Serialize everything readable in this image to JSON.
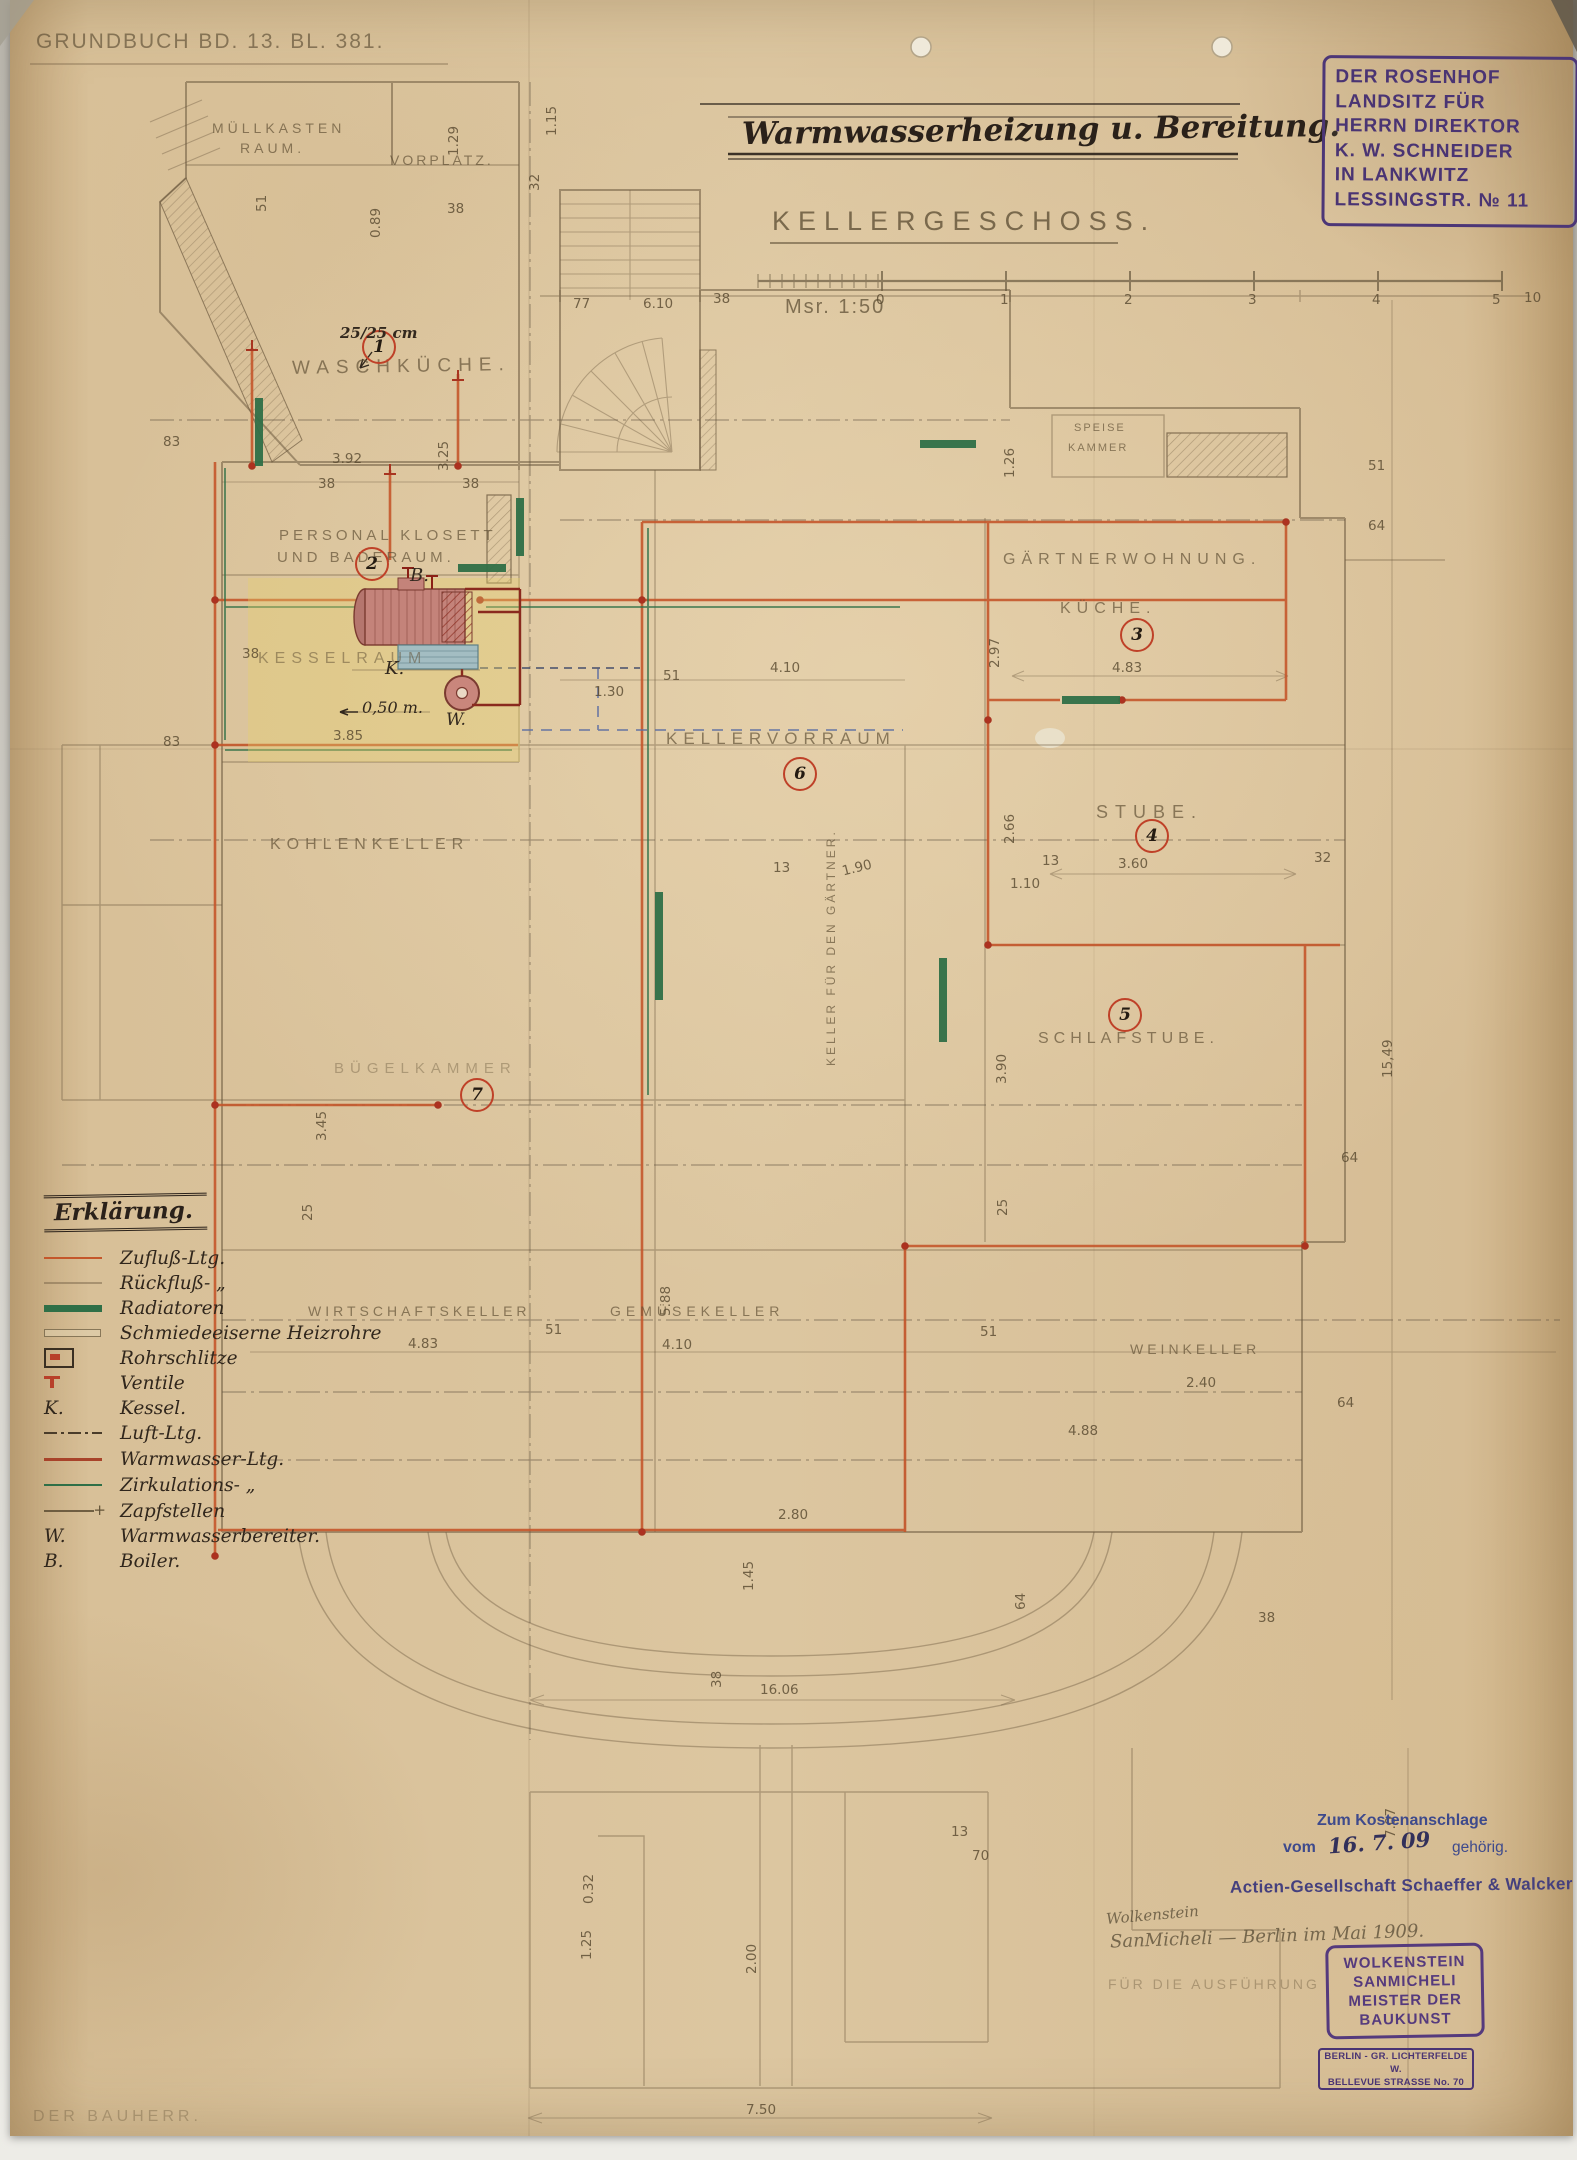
{
  "header": {
    "grundbuch": "Grundbuch Bd. 13. Bl. 381.",
    "title": "Warmwasserheizung u. Bereitung.",
    "floor": "Kellergeschoss.",
    "scale": "Msr. 1:50",
    "scale_ticks": [
      "0",
      "1",
      "2",
      "3",
      "4",
      "5"
    ]
  },
  "owner_stamp": {
    "l1": "DER ROSENHOF",
    "l2": "LANDSITZ FÜR",
    "l3": "HERRN DIREKTOR",
    "l4": "K. W. SCHNEIDER",
    "l5": "IN LANKWITZ",
    "l6": "LESSINGSTR. № 11"
  },
  "rooms": {
    "muellkasten_1": "Müllkasten",
    "muellkasten_2": "Raum.",
    "vorplatz": "Vorplatz.",
    "waschkueche": {
      "number": "1",
      "label": "Waschküche."
    },
    "bad": {
      "number": "2",
      "line1": "Personal Klosett",
      "line2": "und Baderaum."
    },
    "kesselraum": "Kesselraum",
    "gaertner": {
      "number": "3",
      "line1": "Gärtnerwohnung.",
      "line2": "Küche."
    },
    "speisekammer_1": "Speise",
    "speisekammer_2": "Kammer",
    "kellervorraum": {
      "number": "6",
      "label": "Kellervorraum"
    },
    "stube": {
      "number": "4",
      "label": "Stube."
    },
    "schlafstube": {
      "number": "5",
      "label": "Schlafstube."
    },
    "kohlenkeller": "Kohlenkeller",
    "buegelkammer": {
      "number": "7",
      "label": "Bügelkammer"
    },
    "wirtschaftskeller": "Wirtschaftskeller",
    "gemuesekeller": "Gemüsekeller",
    "weinkeller": "Weinkeller",
    "gaertnerkeller": "Keller für den Gärtner."
  },
  "annotations": {
    "boiler": "B.",
    "kessel": "K.",
    "warmwasser": "W.",
    "pipe_size": "25/25 cm",
    "depth": "0,50 m."
  },
  "legend": {
    "heading": "Erklärung.",
    "items": [
      {
        "prefix": "",
        "label": "Zufluß-Ltg."
      },
      {
        "prefix": "",
        "label": "Rückfluß- „"
      },
      {
        "prefix": "",
        "label": "Radiatoren"
      },
      {
        "prefix": "",
        "label": "Schmiedeeiserne Heizrohre"
      },
      {
        "prefix": "",
        "label": "Rohrschlitze"
      },
      {
        "prefix": "",
        "label": "Ventile"
      },
      {
        "prefix": "K.",
        "label": "Kessel."
      },
      {
        "prefix": "",
        "label": "Luft-Ltg."
      },
      {
        "prefix": "",
        "label": "Warmwasser-Ltg."
      },
      {
        "prefix": "",
        "label": "Zirkulations- „"
      },
      {
        "prefix": "",
        "label": "Zapfstellen"
      },
      {
        "prefix": "W.",
        "label": "Warmwasserbereiter."
      },
      {
        "prefix": "B.",
        "label": "Boiler."
      }
    ]
  },
  "footer": {
    "bauherr": "Der Bauherr.",
    "kosten_1": "Zum Kostenanschlage",
    "kosten_vom": "vom",
    "kosten_date": "16. 7. 09",
    "kosten_2": "gehörig.",
    "firm": "Actien-Gesellschaft Schaeffer & Walcker",
    "sig_1": "Wolkenstein",
    "sig_2": "SanMicheli — Berlin im Mai 1909.",
    "ausfuehrung": "Für die Ausführung",
    "builder_stamp": {
      "l1": "WOLKENSTEIN",
      "l2": "SANMICHELI",
      "l3": "MEISTER DER",
      "l4": "BAUKUNST"
    },
    "address_stamp": {
      "l1": "BERLIN - GR. LICHTERFELDE W.",
      "l2": "BELLEVUE STRASSE No. 70"
    }
  },
  "dims": {
    "d01": "3.92",
    "d02": "38",
    "d03": "38",
    "d04": "3.25",
    "d05": "83",
    "d06": "83",
    "d07": "77",
    "d08": "38",
    "d09": "6.10",
    "d10": "1.15",
    "d11": "32",
    "d12": "51",
    "d13": "0.89",
    "d14": "1.29",
    "d15": "38",
    "d16": "1.26",
    "d17": "64",
    "d18": "51",
    "d19": "2.97",
    "d20": "4.83",
    "d21": "1.30",
    "d22": "51",
    "d23": "4.10",
    "d24": "2.66",
    "d25": "1.10",
    "d26": "3.60",
    "d27": "13",
    "d28": "32",
    "d29": "1.90",
    "d30": "13",
    "d31": "3.90",
    "d32": "3.45",
    "d33": "25",
    "d34": "25",
    "d35": "5.88",
    "d36": "4.83",
    "d37": "51",
    "d38": "4.10",
    "d39": "51",
    "d40": "2.40",
    "d41": "64",
    "d42": "4.88",
    "d43": "64",
    "d44": "2.80",
    "d45": "1.45",
    "d46": "38",
    "d47": "16.06",
    "d48": "38",
    "d49": "15,49",
    "d50": "7.07",
    "d51": "0.32",
    "d52": "1.25",
    "d53": "2.00",
    "d54": "13",
    "d55": "70",
    "d56": "7.50",
    "d57": "10",
    "d58": "64",
    "d59": "38",
    "d60": "3.85"
  }
}
